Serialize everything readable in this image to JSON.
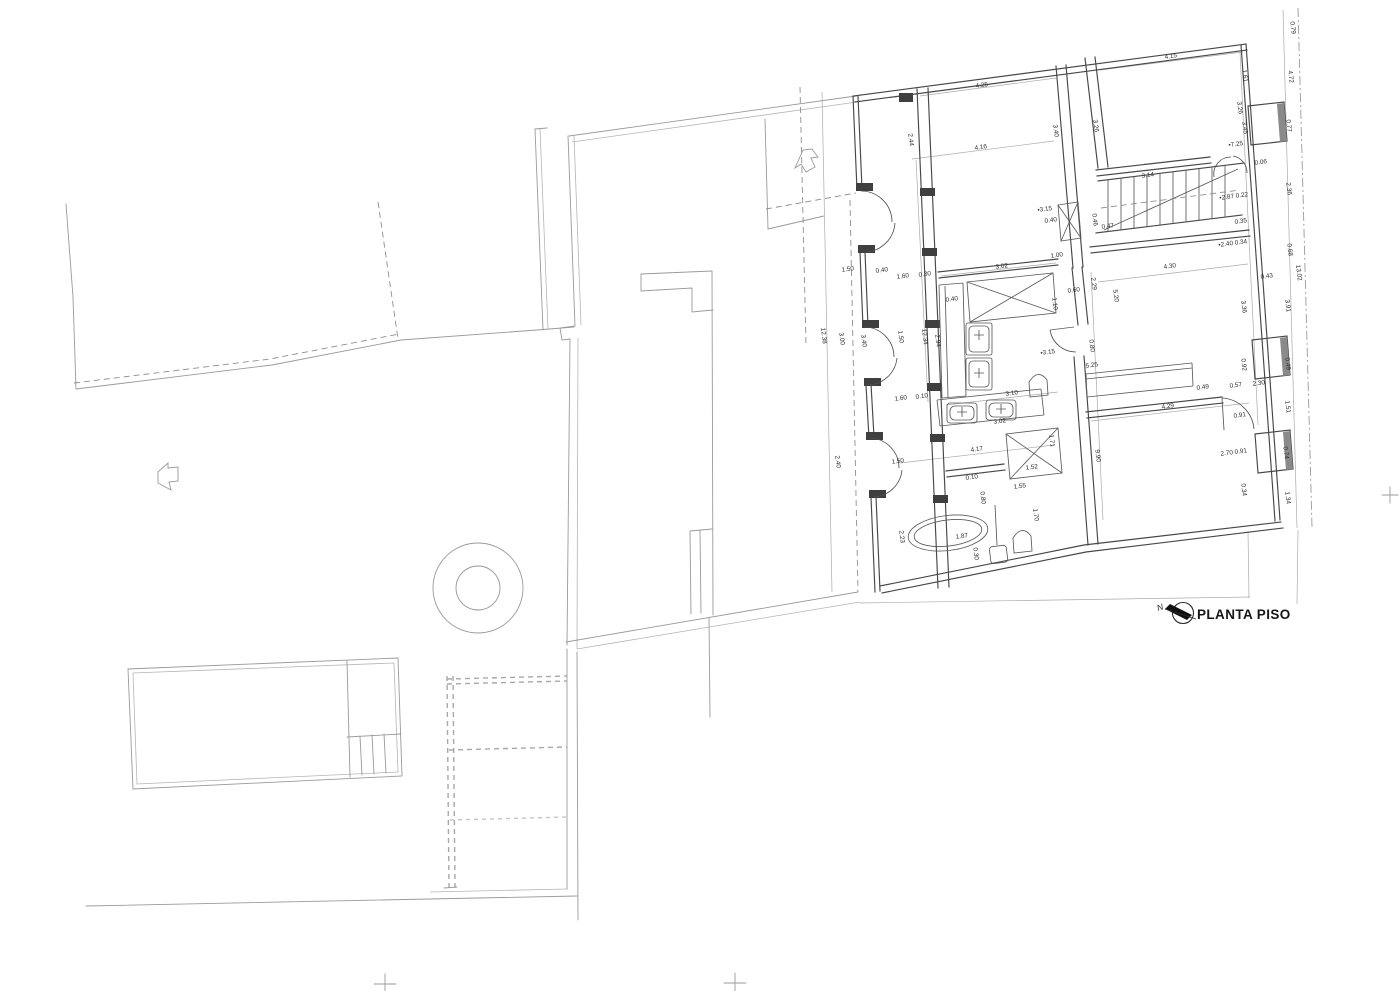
{
  "title": {
    "label": "PLANTA PISO",
    "north_letter": "N"
  },
  "colors": {
    "background": "#ffffff",
    "site_line": "#9a9a9a",
    "wall_line": "#474747",
    "dimension_text": "#2d2d2d",
    "north_needle": "#111111"
  },
  "annotations": [
    {
      "x": 982,
      "y": 87,
      "t": "4.25",
      "r": -7.5
    },
    {
      "x": 1171,
      "y": 58,
      "t": "4.15",
      "r": -7.5
    },
    {
      "x": 1291,
      "y": 28,
      "t": "0.79",
      "r": 83
    },
    {
      "x": 909,
      "y": 140,
      "t": "2.44",
      "r": 83
    },
    {
      "x": 981,
      "y": 149,
      "t": "4.16",
      "r": -7.5
    },
    {
      "x": 1054,
      "y": 131,
      "t": "3.40",
      "r": 83
    },
    {
      "x": 1094,
      "y": 126,
      "t": "3.26",
      "r": 83
    },
    {
      "x": 1243,
      "y": 76,
      "t": "1.61",
      "r": 83
    },
    {
      "x": 1289,
      "y": 77,
      "t": "4.72",
      "r": 83
    },
    {
      "x": 1238,
      "y": 108,
      "t": "3.26",
      "r": 83
    },
    {
      "x": 1243,
      "y": 128,
      "t": "3.45",
      "r": 83
    },
    {
      "x": 1287,
      "y": 126,
      "t": "0.77",
      "r": 83
    },
    {
      "x": 1236,
      "y": 146,
      "t": "•7.25",
      "r": -7.5
    },
    {
      "x": 1261,
      "y": 164,
      "t": "0.06",
      "r": -7.5
    },
    {
      "x": 1148,
      "y": 177,
      "t": "3.14",
      "r": -7.5
    },
    {
      "x": 1287,
      "y": 189,
      "t": "2.36",
      "r": 83
    },
    {
      "x": 1234,
      "y": 198,
      "t": "•2.87 0.22",
      "r": -7.5
    },
    {
      "x": 1241,
      "y": 223,
      "t": "0.35",
      "r": -7.5
    },
    {
      "x": 1093,
      "y": 220,
      "t": "0.46",
      "r": 83
    },
    {
      "x": 1108,
      "y": 228,
      "t": "0.47",
      "r": -7.5
    },
    {
      "x": 1045,
      "y": 211,
      "t": "•3.15",
      "r": -7.5
    },
    {
      "x": 1051,
      "y": 222,
      "t": "0.40",
      "r": -7.5
    },
    {
      "x": 1057,
      "y": 257,
      "t": "1.00",
      "r": -7.5
    },
    {
      "x": 1002,
      "y": 268,
      "t": "3.02",
      "r": -7.5
    },
    {
      "x": 1092,
      "y": 284,
      "t": "2.29",
      "r": 83
    },
    {
      "x": 1114,
      "y": 296,
      "t": "5.20",
      "r": 83
    },
    {
      "x": 1074,
      "y": 292,
      "t": "0.60",
      "r": -7.5
    },
    {
      "x": 952,
      "y": 301,
      "t": "0.40",
      "r": -7.5
    },
    {
      "x": 1053,
      "y": 304,
      "t": "1.10",
      "r": 83
    },
    {
      "x": 923,
      "y": 337,
      "t": "12.34",
      "r": 83
    },
    {
      "x": 936,
      "y": 341,
      "t": "2.94",
      "r": 83
    },
    {
      "x": 899,
      "y": 337,
      "t": "1.50",
      "r": 83
    },
    {
      "x": 822,
      "y": 336,
      "t": "12.38",
      "r": 83
    },
    {
      "x": 840,
      "y": 339,
      "t": "3.00",
      "r": 83
    },
    {
      "x": 862,
      "y": 341,
      "t": "3.40",
      "r": 83
    },
    {
      "x": 1048,
      "y": 354,
      "t": "•3.15",
      "r": -7.5
    },
    {
      "x": 1090,
      "y": 346,
      "t": "0.80",
      "r": 83
    },
    {
      "x": 1092,
      "y": 367,
      "t": "5.25",
      "r": -7.5
    },
    {
      "x": 1012,
      "y": 395,
      "t": "3.10",
      "r": -7.5
    },
    {
      "x": 1000,
      "y": 423,
      "t": "3.02",
      "r": -7.5
    },
    {
      "x": 1233,
      "y": 245,
      "t": "•2.40 0.34",
      "r": -7.5
    },
    {
      "x": 1288,
      "y": 250,
      "t": "0.68",
      "r": 83
    },
    {
      "x": 1170,
      "y": 268,
      "t": "4.30",
      "r": -7.5
    },
    {
      "x": 1267,
      "y": 278,
      "t": "0.43",
      "r": -7.5
    },
    {
      "x": 1297,
      "y": 273,
      "t": "13.02",
      "r": 83
    },
    {
      "x": 1242,
      "y": 307,
      "t": "3.36",
      "r": 83
    },
    {
      "x": 1286,
      "y": 306,
      "t": "3.91",
      "r": 83
    },
    {
      "x": 1242,
      "y": 365,
      "t": "0.92",
      "r": 83
    },
    {
      "x": 1286,
      "y": 364,
      "t": "0.49",
      "r": 83
    },
    {
      "x": 1203,
      "y": 389,
      "t": "0.49",
      "r": -7.5
    },
    {
      "x": 1236,
      "y": 387,
      "t": "0.57",
      "r": -7.5
    },
    {
      "x": 1259,
      "y": 385,
      "t": "2.30",
      "r": -7.5
    },
    {
      "x": 1168,
      "y": 408,
      "t": "4.29",
      "r": -7.5
    },
    {
      "x": 1286,
      "y": 407,
      "t": "1.51",
      "r": 83
    },
    {
      "x": 1240,
      "y": 417,
      "t": "0.91",
      "r": -7.5
    },
    {
      "x": 1096,
      "y": 456,
      "t": "9.90",
      "r": 83
    },
    {
      "x": 1234,
      "y": 454,
      "t": "2.70 0.91",
      "r": -7.5
    },
    {
      "x": 1284,
      "y": 453,
      "t": "0.74",
      "r": 83
    },
    {
      "x": 1242,
      "y": 490,
      "t": "0.34",
      "r": 83
    },
    {
      "x": 1286,
      "y": 498,
      "t": "1.34",
      "r": 83
    },
    {
      "x": 977,
      "y": 451,
      "t": "4.17",
      "r": -7.5
    },
    {
      "x": 1050,
      "y": 441,
      "t": "1.71",
      "r": 83
    },
    {
      "x": 1032,
      "y": 469,
      "t": "1.52",
      "r": -7.5
    },
    {
      "x": 972,
      "y": 479,
      "t": "0.10",
      "r": -7.5
    },
    {
      "x": 981,
      "y": 498,
      "t": "0.80",
      "r": 83
    },
    {
      "x": 1020,
      "y": 488,
      "t": "1.55",
      "r": -7.5
    },
    {
      "x": 1034,
      "y": 515,
      "t": "1.70",
      "r": 83
    },
    {
      "x": 962,
      "y": 538,
      "t": "1.87",
      "r": -7.5
    },
    {
      "x": 900,
      "y": 537,
      "t": "2.23",
      "r": 83
    },
    {
      "x": 974,
      "y": 554,
      "t": "0.30",
      "r": 83
    },
    {
      "x": 848,
      "y": 271,
      "t": "1.50",
      "r": -7.5
    },
    {
      "x": 882,
      "y": 272,
      "t": "0.40",
      "r": -7.5
    },
    {
      "x": 903,
      "y": 278,
      "t": "1.60",
      "r": -7.5
    },
    {
      "x": 925,
      "y": 276,
      "t": "0.30",
      "r": -7.5
    },
    {
      "x": 901,
      "y": 400,
      "t": "1.60",
      "r": -7.5
    },
    {
      "x": 922,
      "y": 398,
      "t": "0.10",
      "r": -7.5
    },
    {
      "x": 836,
      "y": 462,
      "t": "2.40",
      "r": 83
    },
    {
      "x": 898,
      "y": 463,
      "t": "1.50",
      "r": -7.5
    }
  ]
}
